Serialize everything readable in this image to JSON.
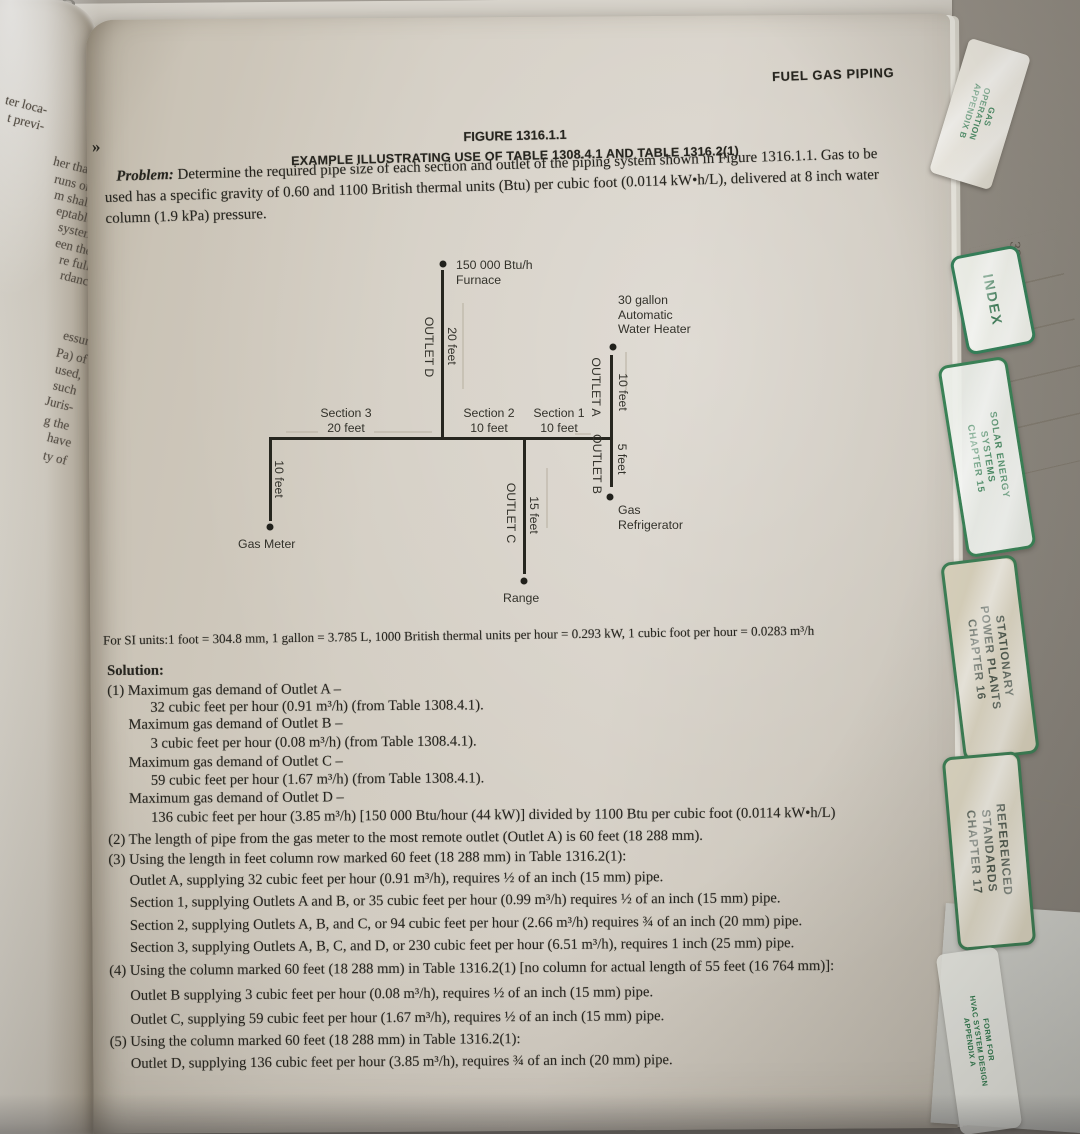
{
  "corner_note": "3",
  "running_header": "FUEL GAS PIPING",
  "figure": {
    "title": "FIGURE 1316.1.1",
    "subtitle": "EXAMPLE ILLUSTRATING USE OF TABLE 1308.4.1 AND TABLE 1316.2(1)"
  },
  "problem": {
    "label": "Problem:",
    "text": "Determine the required pipe size of each section and outlet of the piping system shown in Figure 1316.1.1. Gas to be used has a specific gravity of 0.60 and 1100 British thermal units (Btu) per cubic foot (0.0114 kW•h/L), delivered at 8 inch water column (1.9 kPa) pressure."
  },
  "diagram": {
    "furnace_line1": "150 000 Btu/h",
    "furnace_line2": "Furnace",
    "water_heater_line1": "30 gallon",
    "water_heater_line2": "Automatic",
    "water_heater_line3": "Water Heater",
    "outlet_d": "OUTLET D",
    "outlet_d_len": "20 feet",
    "outlet_a": "OUTLET A",
    "outlet_a_len": "10 feet",
    "outlet_b": "OUTLET B",
    "outlet_b_len": "5 feet",
    "outlet_c": "OUTLET C",
    "outlet_c_len": "15 feet",
    "meter_drop_len": "10 feet",
    "section3_line1": "Section 3",
    "section3_line2": "20 feet",
    "section2_line1": "Section 2",
    "section2_line2": "10 feet",
    "section1_line1": "Section 1",
    "section1_line2": "10 feet",
    "gas_meter": "Gas Meter",
    "refrigerator_line1": "Gas",
    "refrigerator_line2": "Refrigerator",
    "range": "Range"
  },
  "si_note": "For SI units:1 foot = 304.8 mm, 1 gallon = 3.785 L, 1000 British thermal units per hour = 0.293 kW, 1 cubic foot per hour = 0.0283 m³/h",
  "solution": {
    "label": "Solution:",
    "lines": [
      "(1) Maximum gas demand of Outlet A –",
      "32 cubic feet per hour (0.91 m³/h) (from Table 1308.4.1).",
      "Maximum gas demand of Outlet B –",
      "3 cubic feet per hour (0.08 m³/h) (from Table 1308.4.1).",
      "Maximum gas demand of Outlet C –",
      "59 cubic feet per hour (1.67 m³/h) (from Table 1308.4.1).",
      "Maximum gas demand of Outlet D –",
      "136 cubic feet per hour (3.85 m³/h) [150 000 Btu/hour (44 kW)] divided by 1100 Btu per cubic foot (0.0114 kW•h/L)",
      "(2) The length of pipe from the gas meter to the most remote outlet (Outlet A) is 60 feet (18 288 mm).",
      "(3) Using the length in feet column row marked 60 feet (18 288 mm) in Table 1316.2(1):",
      "Outlet A, supplying 32 cubic feet per hour (0.91 m³/h), requires ½ of an inch (15 mm) pipe.",
      "Section 1, supplying Outlets A and B, or 35 cubic feet per hour (0.99 m³/h) requires ½ of an inch (15 mm) pipe.",
      "Section 2, supplying Outlets A, B, and C, or 94 cubic feet per hour (2.66 m³/h) requires ¾ of an inch (20 mm) pipe.",
      "Section 3, supplying Outlets A, B, C, and D, or 230 cubic feet per hour (6.51 m³/h), requires 1 inch (25 mm) pipe.",
      "(4) Using the column marked 60 feet (18 288 mm) in Table 1316.2(1) [no column for actual length of 55 feet (16 764 mm)]:",
      "Outlet B supplying 3 cubic feet per hour (0.08 m³/h), requires ½ of an inch (15 mm) pipe.",
      "Outlet C, supplying 59 cubic feet per hour (1.67 m³/h), requires ½ of an inch (15 mm) pipe.",
      "(5) Using the column marked 60 feet (18 288 mm) in Table 1316.2(1):",
      "Outlet D, supplying 136 cubic feet per hour (3.85 m³/h), requires ¾ of an inch (20 mm) pipe."
    ]
  },
  "margin_fragments": [
    "ter loca-",
    "t previ-",
    "her than",
    "runs or",
    "m shall",
    "eptable",
    "system",
    "een the",
    "re full",
    "rdance",
    "essure",
    "Pa) of",
    "used,",
    "such",
    "Juris-",
    "g the",
    "have",
    "ty of"
  ],
  "marks": {
    "right_guillemet": "»",
    "left_guillemet": "«"
  },
  "tabs": {
    "appendix_b": {
      "line1": "GAS",
      "line2": "OPERATION",
      "line3": "APPENDIX B"
    },
    "index_label": "INDEX",
    "sheet_note": "325",
    "chapter15": {
      "line1": "SOLAR ENERGY",
      "line2": "SYSTEMS",
      "line3": "CHAPTER 15"
    },
    "chapter16": {
      "line1": "STATIONARY",
      "line2": "POWER PLANTS",
      "line3": "CHAPTER 16"
    },
    "chapter17": {
      "line1": "REFERENCED",
      "line2": "STANDARDS",
      "line3": "CHAPTER 17"
    },
    "appendix_a": {
      "line1": "FORM FOR",
      "line2": "HVAC SYSTEM DESIGN",
      "line3": "APPENDIX A"
    }
  },
  "colors": {
    "tab_green": "#2f7a4e",
    "page": "#d2ccc1",
    "ink": "#26251f"
  }
}
